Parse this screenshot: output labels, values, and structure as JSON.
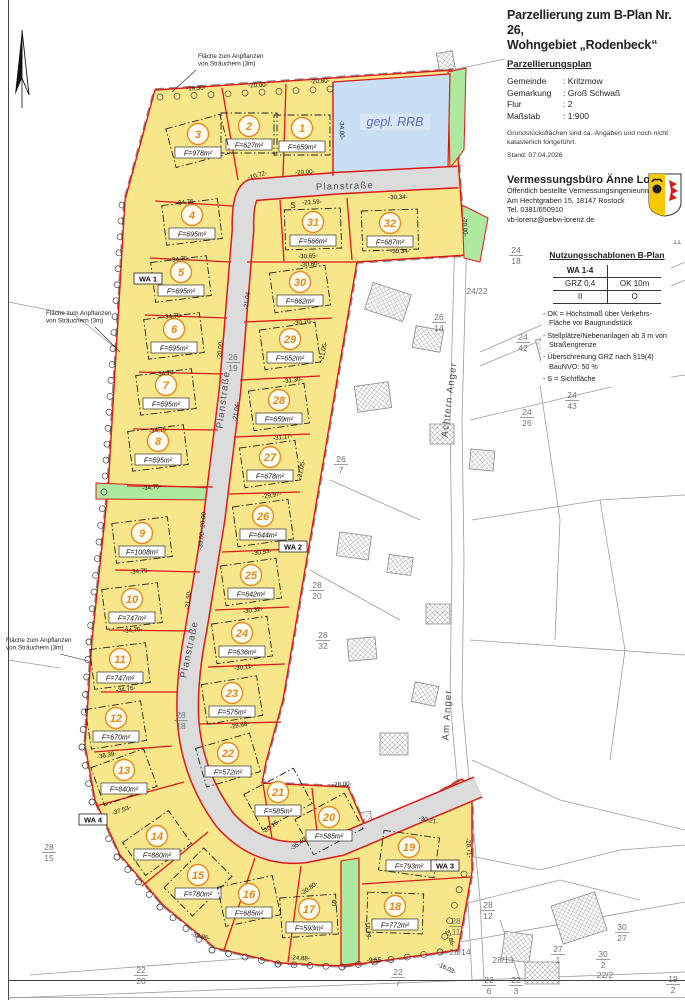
{
  "legend": {
    "title_line1": "Parzellierung zum B-Plan Nr. 26,",
    "title_line2": "Wohngebiet „Rodenbeck“",
    "subtitle": "Parzellierungsplan",
    "info_rows": [
      {
        "label": "Gemeinde",
        "value": "Kritzmow"
      },
      {
        "label": "Gemarkung",
        "value": "Groß Schwaß"
      },
      {
        "label": "Flur",
        "value": "2"
      },
      {
        "label": "Maßstab",
        "value": "1:900"
      }
    ],
    "note_line1": "Grundstücksflächen sind ca.-Angaben und noch nicht",
    "note_line2": "katasterlich fortgeführt.",
    "stand": "Stand: 07.04.2026",
    "firm": {
      "name": "Vermessungsbüro Änne Lorenz",
      "role": "Öffentlich bestellte Vermessungsingenieurin",
      "address": "Am Hechtgraben 15, 18147 Rostock",
      "phone": "Tel. 0381/650910",
      "email": "vb-lorenz@oebvi-lorenz.de"
    },
    "nutzung": {
      "heading": "Nutzungsschablonen B-Plan",
      "table": [
        [
          "WA 1-4",
          ""
        ],
        [
          "GRZ 0,4",
          "OK 10m"
        ],
        [
          "II",
          "O"
        ]
      ],
      "bullets": [
        "OK = Höchstmaß über Verkehrs-Fläche vor Baugrundstück",
        "Stellplätze/Nebenanlagen ab 3 m von Straßengrenze",
        "Überschreitung GRZ nach §19(4) BauNVO: 50 %",
        "S = Sichtfläche"
      ]
    }
  },
  "map": {
    "colors": {
      "yellow": "#F7E78A",
      "street": "#DCDCDC",
      "red": "#E01818",
      "green": "#AEE9A0",
      "water": "#C9DFF2",
      "orange": "#E8891F",
      "gray": "#9A9A9A",
      "fraction_gray": "#737373",
      "water_text": "#5A6FC0"
    },
    "rrb_label": "gepl. RRB",
    "parcels": [
      {
        "n": "1",
        "a": "659",
        "x": 302,
        "y": 133,
        "r": 0
      },
      {
        "n": "2",
        "a": "627",
        "x": 249,
        "y": 131,
        "r": 0
      },
      {
        "n": "3",
        "a": "978",
        "x": 198,
        "y": 139,
        "r": -15
      },
      {
        "n": "4",
        "a": "695",
        "x": 192,
        "y": 220,
        "r": -7
      },
      {
        "n": "5",
        "a": "695",
        "x": 181,
        "y": 277,
        "r": -7
      },
      {
        "n": "6",
        "a": "695",
        "x": 174,
        "y": 334,
        "r": -7
      },
      {
        "n": "7",
        "a": "695",
        "x": 166,
        "y": 390,
        "r": -7
      },
      {
        "n": "8",
        "a": "695",
        "x": 158,
        "y": 446,
        "r": -7
      },
      {
        "n": "9",
        "a": "1008",
        "x": 142,
        "y": 538,
        "r": -7
      },
      {
        "n": "10",
        "a": "747",
        "x": 132,
        "y": 604,
        "r": -7
      },
      {
        "n": "11",
        "a": "747",
        "x": 120,
        "y": 664,
        "r": -7
      },
      {
        "n": "12",
        "a": "670",
        "x": 116,
        "y": 723,
        "r": -9
      },
      {
        "n": "13",
        "a": "840",
        "x": 124,
        "y": 775,
        "r": -20
      },
      {
        "n": "14",
        "a": "860",
        "x": 157,
        "y": 841,
        "r": -35
      },
      {
        "n": "15",
        "a": "780",
        "x": 198,
        "y": 880,
        "r": -45
      },
      {
        "n": "16",
        "a": "685",
        "x": 249,
        "y": 899,
        "r": -12
      },
      {
        "n": "17",
        "a": "593",
        "x": 309,
        "y": 914,
        "r": -4
      },
      {
        "n": "18",
        "a": "772",
        "x": 395,
        "y": 911,
        "r": 2
      },
      {
        "n": "19",
        "a": "793",
        "x": 409,
        "y": 852,
        "r": 8
      },
      {
        "n": "20",
        "a": "585",
        "x": 329,
        "y": 822,
        "r": -28
      },
      {
        "n": "21",
        "a": "585",
        "x": 278,
        "y": 797,
        "r": -28
      },
      {
        "n": "22",
        "a": "572",
        "x": 228,
        "y": 758,
        "r": -16
      },
      {
        "n": "23",
        "a": "575",
        "x": 232,
        "y": 698,
        "r": -9
      },
      {
        "n": "24",
        "a": "636",
        "x": 242,
        "y": 638,
        "r": -8
      },
      {
        "n": "25",
        "a": "642",
        "x": 251,
        "y": 580,
        "r": -8
      },
      {
        "n": "26",
        "a": "644",
        "x": 263,
        "y": 521,
        "r": -8
      },
      {
        "n": "27",
        "a": "678",
        "x": 270,
        "y": 462,
        "r": -8
      },
      {
        "n": "28",
        "a": "659",
        "x": 279,
        "y": 405,
        "r": -8
      },
      {
        "n": "29",
        "a": "652",
        "x": 290,
        "y": 344,
        "r": -8
      },
      {
        "n": "30",
        "a": "662",
        "x": 300,
        "y": 287,
        "r": -8
      },
      {
        "n": "31",
        "a": "566",
        "x": 313,
        "y": 227,
        "r": -2
      },
      {
        "n": "32",
        "a": "687",
        "x": 390,
        "y": 228,
        "r": -2
      }
    ],
    "dims": [
      {
        "t": "-19,30-",
        "x": 196,
        "y": 90,
        "r": -3
      },
      {
        "t": "-20,00-",
        "x": 258,
        "y": 87,
        "r": -3
      },
      {
        "t": "-20,60-",
        "x": 320,
        "y": 83,
        "r": -3
      },
      {
        "t": "-34,00-",
        "x": 340,
        "y": 130,
        "r": 88
      },
      {
        "t": "-20,00-",
        "x": 305,
        "y": 174,
        "r": -3
      },
      {
        "t": "-10,72-",
        "x": 258,
        "y": 177,
        "r": -15
      },
      {
        "t": "-21,59-",
        "x": 312,
        "y": 204,
        "r": -3
      },
      {
        "t": "-30,34-",
        "x": 398,
        "y": 199,
        "r": -2
      },
      {
        "t": "-30,65-",
        "x": 308,
        "y": 258,
        "r": -3
      },
      {
        "t": "-30,34-",
        "x": 400,
        "y": 253,
        "r": -2
      },
      {
        "t": "-20,00-",
        "x": 463,
        "y": 227,
        "r": 87
      },
      {
        "t": "-34,75-",
        "x": 186,
        "y": 204,
        "r": -6
      },
      {
        "t": "-34,75-",
        "x": 180,
        "y": 261,
        "r": -6
      },
      {
        "t": "-34,75-",
        "x": 173,
        "y": 318,
        "r": -6
      },
      {
        "t": "-34,75-",
        "x": 166,
        "y": 375,
        "r": -6
      },
      {
        "t": "-34,75-",
        "x": 159,
        "y": 432,
        "r": -6
      },
      {
        "t": "-34,75-",
        "x": 152,
        "y": 489,
        "r": -6
      },
      {
        "t": "-34,75-",
        "x": 140,
        "y": 573,
        "r": -6
      },
      {
        "t": "-34,75-",
        "x": 133,
        "y": 632,
        "r": -6
      },
      {
        "t": "-34,75-",
        "x": 126,
        "y": 691,
        "r": -8
      },
      {
        "t": "-36,39-",
        "x": 107,
        "y": 757,
        "r": -10
      },
      {
        "t": "-37,53-",
        "x": 122,
        "y": 812,
        "r": -18
      },
      {
        "t": "-30,80-",
        "x": 310,
        "y": 266,
        "r": -6
      },
      {
        "t": "-30,70-",
        "x": 303,
        "y": 324,
        "r": -7
      },
      {
        "t": "-31,30-",
        "x": 293,
        "y": 382,
        "r": -7
      },
      {
        "t": "-31,17-",
        "x": 283,
        "y": 439,
        "r": -7
      },
      {
        "t": "-29,97-",
        "x": 272,
        "y": 497,
        "r": -8
      },
      {
        "t": "-30,53-",
        "x": 262,
        "y": 554,
        "r": -8
      },
      {
        "t": "-30,32-",
        "x": 253,
        "y": 612,
        "r": -8
      },
      {
        "t": "-30,11-",
        "x": 244,
        "y": 669,
        "r": -8
      },
      {
        "t": "-29,68-",
        "x": 240,
        "y": 727,
        "r": -12
      },
      {
        "t": "-21,04-",
        "x": 249,
        "y": 300,
        "r": -82
      },
      {
        "t": "-21,04-",
        "x": 238,
        "y": 412,
        "r": -82
      },
      {
        "t": "-21,05-",
        "x": 325,
        "y": 352,
        "r": -78
      },
      {
        "t": "-21,05-",
        "x": 303,
        "y": 470,
        "r": -78
      },
      {
        "t": "-20,00-",
        "x": 222,
        "y": 350,
        "r": -84
      },
      {
        "t": "-20,00-",
        "x": 205,
        "y": 520,
        "r": -84
      },
      {
        "t": "-39,00-",
        "x": 203,
        "y": 540,
        "r": -84
      },
      {
        "t": "-21,50-",
        "x": 190,
        "y": 600,
        "r": -84
      },
      {
        "t": "-28,00-",
        "x": 342,
        "y": 786,
        "r": -3
      },
      {
        "t": "-30,21-",
        "x": 428,
        "y": 822,
        "r": 12
      },
      {
        "t": "-28,71-",
        "x": 467,
        "y": 848,
        "r": 85
      },
      {
        "t": "-27,86-",
        "x": 448,
        "y": 938,
        "r": 68
      },
      {
        "t": "-18,79-",
        "x": 366,
        "y": 930,
        "r": 85
      },
      {
        "t": "-35,40-",
        "x": 300,
        "y": 845,
        "r": -35
      },
      {
        "t": "-20,80-",
        "x": 310,
        "y": 890,
        "r": -35
      },
      {
        "t": "-20,15-",
        "x": 272,
        "y": 828,
        "r": -35
      },
      {
        "t": "-32,96-",
        "x": 200,
        "y": 938,
        "r": 14
      },
      {
        "t": "-24,88-",
        "x": 300,
        "y": 960,
        "r": 3
      },
      {
        "t": "-9,65-",
        "x": 375,
        "y": 962,
        "r": 0
      },
      {
        "t": "-16,03-",
        "x": 446,
        "y": 970,
        "r": 25
      }
    ],
    "fractions": [
      {
        "x": 233,
        "y": 360,
        "top": "26",
        "bot": "19"
      },
      {
        "x": 181,
        "y": 718,
        "top": "28",
        "bot": "18"
      },
      {
        "x": 341,
        "y": 462,
        "top": "26",
        "bot": "7"
      },
      {
        "x": 317,
        "y": 588,
        "top": "28",
        "bot": "20"
      },
      {
        "x": 323,
        "y": 638,
        "top": "28",
        "bot": "32"
      },
      {
        "x": 49,
        "y": 850,
        "top": "28",
        "bot": "15"
      },
      {
        "x": 141,
        "y": 973,
        "top": "22",
        "bot": "20"
      },
      {
        "x": 398,
        "y": 975,
        "top": "22",
        "bot": "7"
      },
      {
        "x": 488,
        "y": 908,
        "top": "28",
        "bot": "12"
      },
      {
        "x": 456,
        "y": 924,
        "top": "28",
        "bot": "11"
      },
      {
        "x": 558,
        "y": 952,
        "top": "27",
        "bot": "1"
      },
      {
        "x": 622,
        "y": 930,
        "top": "30",
        "bot": "27"
      },
      {
        "x": 603,
        "y": 957,
        "top": "30",
        "bot": "2"
      },
      {
        "x": 489,
        "y": 983,
        "top": "22",
        "bot": "6"
      },
      {
        "x": 516,
        "y": 983,
        "top": "22",
        "bot": "3"
      },
      {
        "x": 673,
        "y": 982,
        "top": "19",
        "bot": "2"
      },
      {
        "x": 523,
        "y": 340,
        "top": "24",
        "bot": "42"
      },
      {
        "x": 550,
        "y": 375,
        "top": "24",
        "bot": "41"
      },
      {
        "x": 572,
        "y": 398,
        "top": "24",
        "bot": "43"
      },
      {
        "x": 527,
        "y": 415,
        "top": "24",
        "bot": "26"
      },
      {
        "x": 439,
        "y": 320,
        "top": "26",
        "bot": "14"
      },
      {
        "x": 516,
        "y": 253,
        "top": "24",
        "bot": "18"
      },
      {
        "x": 676,
        "y": 210,
        "top": "24",
        "bot": "8"
      },
      {
        "x": 677,
        "y": 233,
        "top": "22",
        "bot": "11"
      },
      {
        "x": 477,
        "y": 294,
        "line": "24/22"
      },
      {
        "x": 460,
        "y": 955,
        "line": "28/14"
      },
      {
        "x": 503,
        "y": 963,
        "line": "28/13"
      },
      {
        "x": 605,
        "y": 978,
        "line": "22/2"
      }
    ],
    "street_labels": [
      {
        "t": "Planstraße",
        "x": 345,
        "y": 189,
        "r": -2
      },
      {
        "t": "Planstraße",
        "x": 226,
        "y": 400,
        "r": -83
      },
      {
        "t": "Planstraße",
        "x": 192,
        "y": 650,
        "r": -78
      },
      {
        "t": "Am Anger",
        "x": 575,
        "y": 316,
        "r": -21
      },
      {
        "t": "Achtern Anger",
        "x": 452,
        "y": 400,
        "r": -83
      },
      {
        "t": "Am Anger",
        "x": 450,
        "y": 715,
        "r": -87
      }
    ],
    "annotations": [
      {
        "lines": [
          "Fläche zum Anpflanzen",
          "von Sträuchern (3m)"
        ],
        "x": 198,
        "y": 58,
        "lx1": 196,
        "ly1": 70,
        "lx2": 172,
        "ly2": 92
      },
      {
        "lines": [
          "Fläche zum Anpflanzen",
          "von Sträuchern (3m)"
        ],
        "x": 46,
        "y": 315,
        "lx1": 95,
        "ly1": 327,
        "lx2": 120,
        "ly2": 352
      },
      {
        "lines": [
          "Fläche zum Anpflanzen",
          "von Sträuchern (3m)"
        ],
        "x": 6,
        "y": 642,
        "lx1": 60,
        "ly1": 654,
        "lx2": 92,
        "ly2": 662
      }
    ],
    "wa_labels": [
      {
        "t": "WA 1",
        "x": 148,
        "y": 281
      },
      {
        "t": "WA 2",
        "x": 293,
        "y": 549
      },
      {
        "t": "WA 3",
        "x": 445,
        "y": 868
      },
      {
        "t": "WA 4",
        "x": 93,
        "y": 822
      }
    ],
    "s_marks": [
      {
        "t": "S",
        "x": 293,
        "y": 208
      },
      {
        "t": "S",
        "x": 334,
        "y": 906
      }
    ]
  }
}
